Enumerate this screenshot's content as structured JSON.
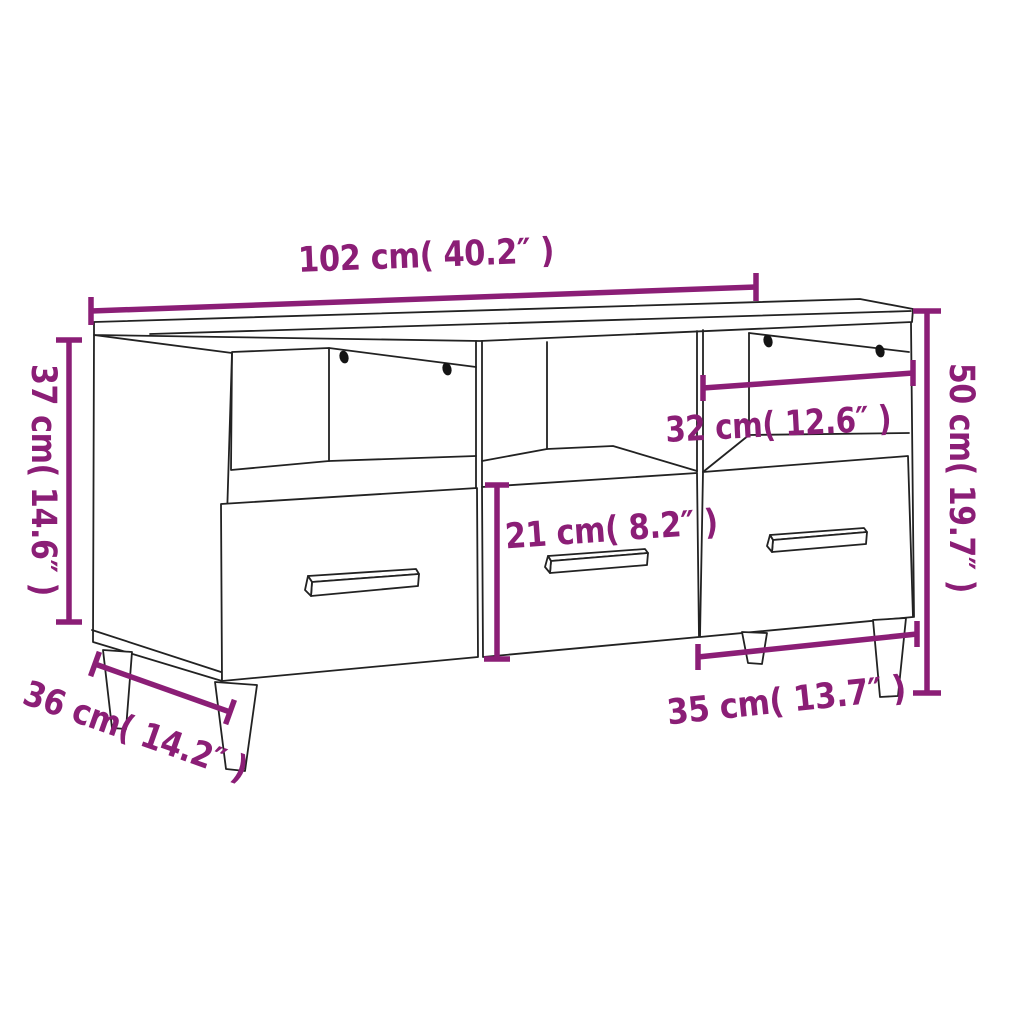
{
  "diagram": {
    "type": "product-dimension-diagram",
    "product": "tv-cabinet-with-3-open-compartments-3-drawers-and-legs",
    "colors": {
      "dimension_accent": "#8B1E76",
      "line_outline": "#222222",
      "background": "#ffffff"
    },
    "dimensions": {
      "overall_width": {
        "label": "102 cm( 40.2″ )",
        "cm": "102",
        "inch": "40.2"
      },
      "body_height_left": {
        "label": "37 cm( 14.6″ )",
        "cm": "37",
        "inch": "14.6"
      },
      "total_height_right": {
        "label": "50 cm( 19.7″ )",
        "cm": "50",
        "inch": "19.7"
      },
      "compartment_width": {
        "label": "32 cm( 12.6″ )",
        "cm": "32",
        "inch": "12.6"
      },
      "drawer_front_height": {
        "label": "21 cm( 8.2″ )",
        "cm": "21",
        "inch": "8.2"
      },
      "depth": {
        "label": "36 cm( 14.2″ )",
        "cm": "36",
        "inch": "14.2"
      },
      "drawer_width": {
        "label": "35 cm( 13.7″ )",
        "cm": "35",
        "inch": "13.7"
      }
    }
  }
}
